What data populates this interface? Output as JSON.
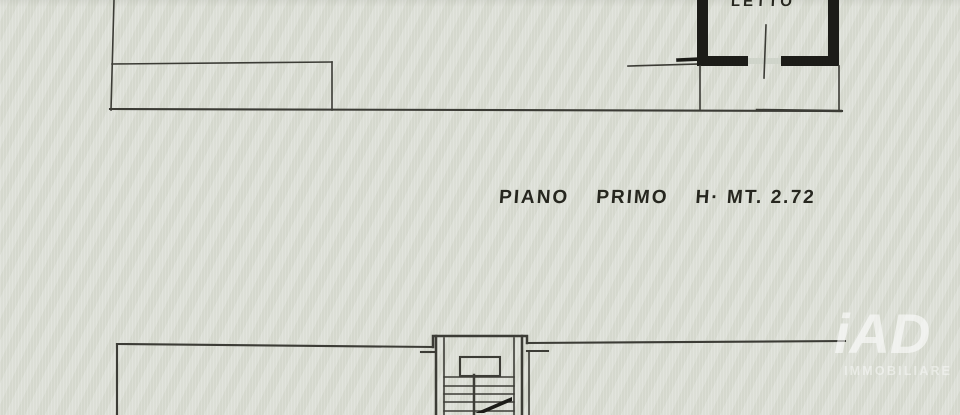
{
  "colors": {
    "background": "#d8dbd2",
    "line": "#3c3c36",
    "wall": "#1c1c18",
    "window_sill": "#cfd4ca",
    "text": "#26261f",
    "watermark": "#ffffff"
  },
  "upper_plan": {
    "room_label": "LETTO"
  },
  "floor_caption": {
    "word1": "PIANO",
    "word2": "PRIMO",
    "word3": "H· MT. 2.72"
  },
  "watermark": {
    "logo": "iAD",
    "subtitle": "IMMOBILIARE"
  }
}
